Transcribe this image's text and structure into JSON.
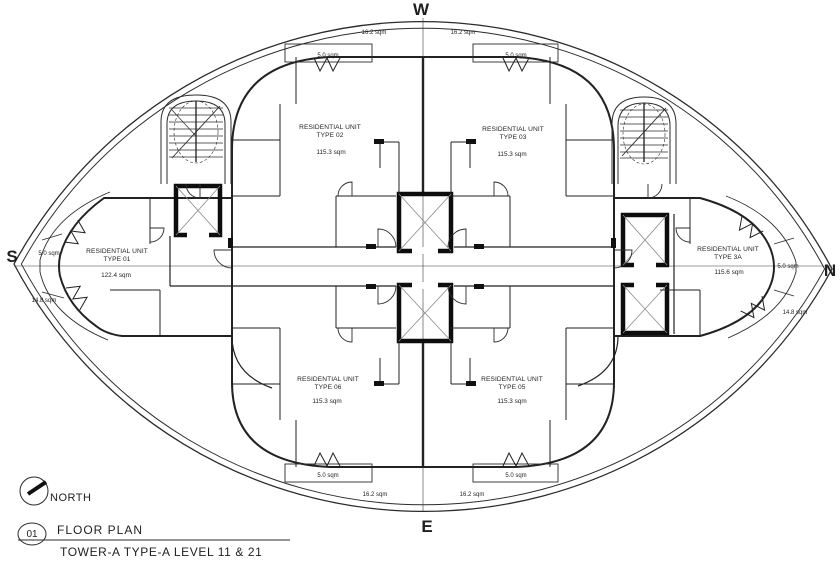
{
  "colors": {
    "background": "#ffffff",
    "lines": "#2b2b2b",
    "accent_red": "#ab1016"
  },
  "compass": {
    "west": "W",
    "east": "E",
    "south": "S",
    "north": "N"
  },
  "north_indicator": {
    "label": "NORTH"
  },
  "title_block": {
    "detail_number": "01",
    "title": "FLOOR PLAN",
    "subtitle": "TOWER-A TYPE-A LEVEL 11 & 21"
  },
  "units": [
    {
      "name": "RESIDENTIAL UNIT",
      "type": "TYPE 01",
      "area": "122.4 sqm"
    },
    {
      "name": "RESIDENTIAL UNIT",
      "type": "TYPE 02",
      "area": "115.3 sqm"
    },
    {
      "name": "RESIDENTIAL UNIT",
      "type": "TYPE 03",
      "area": "115.3 sqm"
    },
    {
      "name": "RESIDENTIAL UNIT",
      "type": "TYPE 3A",
      "area": "115.6 sqm"
    },
    {
      "name": "RESIDENTIAL UNIT",
      "type": "TYPE 05",
      "area": "115.3 sqm"
    },
    {
      "name": "RESIDENTIAL UNIT",
      "type": "TYPE 06",
      "area": "115.3 sqm"
    }
  ],
  "areas": {
    "terrace_16": "16.2 sqm",
    "balcony_5": "5.0 sqm",
    "terrace_14": "14.8 sqm"
  }
}
